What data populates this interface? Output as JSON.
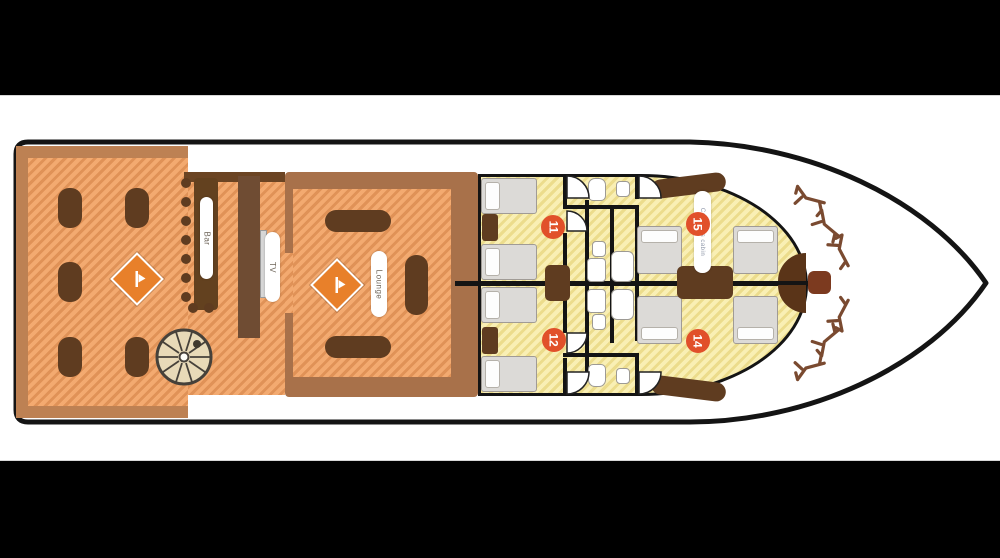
{
  "plan": {
    "type": "yacht-deck-plan",
    "labels": {
      "bar": "Bar",
      "tv": "TV",
      "lounge": "Lounge",
      "bow_cabin": "Captain's cabin"
    },
    "cabins": [
      {
        "number": "11"
      },
      {
        "number": "12"
      },
      {
        "number": "14"
      },
      {
        "number": "15"
      }
    ],
    "icons": [
      "diamond-logo-icon",
      "spiral-staircase-icon",
      "sun-lounger-icon",
      "toilet-icon",
      "sink-icon",
      "shower-icon",
      "door-swing-icon"
    ],
    "colors": {
      "deck": "#f3aa70",
      "deck_stripe": "#e09257",
      "wood_dark": "#5f3c20",
      "wall_brown": "#a8714a",
      "wall_dark": "#6b4423",
      "tan_border": "#bd8153",
      "cabin_floor": "#f9efb4",
      "cabin_stripe": "#ecdc8c",
      "badge": "#e1502a",
      "diamond": "#e8802a",
      "hull_line": "#141414",
      "bed_gray": "#dcdad7"
    }
  }
}
